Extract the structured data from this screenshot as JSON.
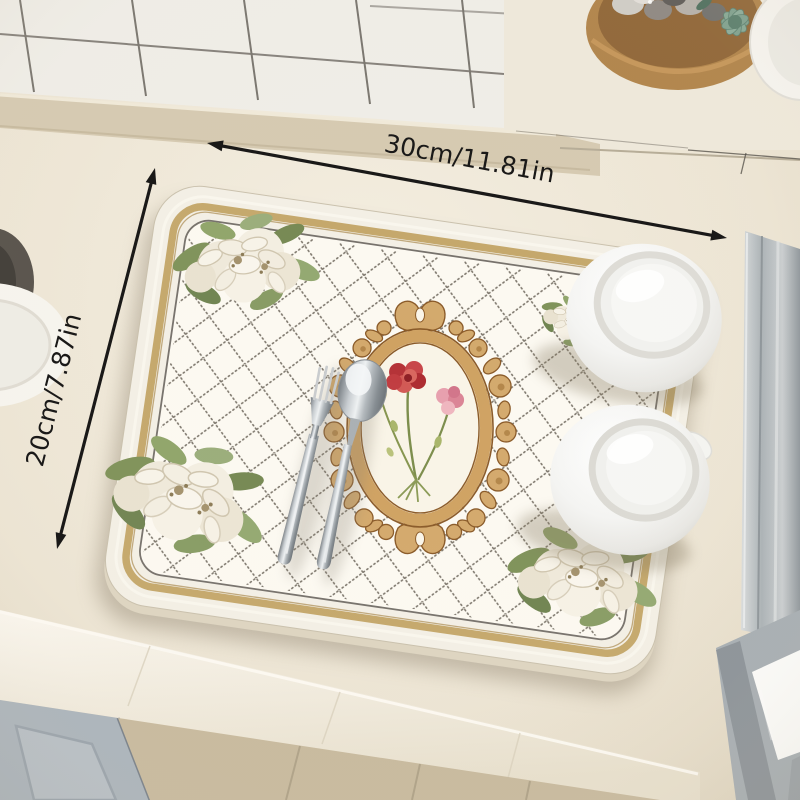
{
  "meta": {
    "type": "product-photo",
    "subject": "quilted dish-drying mat with baroque floral print on a kitchen countertop"
  },
  "annotations": {
    "width_label": "30cm/11.81in",
    "height_label": "20cm/7.87in",
    "arrow_color": "#1a1918"
  },
  "palette": {
    "mat_base": "#f3efe5",
    "mat_border_gold": "#c4a76a",
    "quilt_dot": "#6e675c",
    "ornament_gold": "#cfa262",
    "ornament_outline": "#8a5a28",
    "carnation_red": "#c0393c",
    "carnation_pink": "#e294a0",
    "leaf_green": "#7f9460",
    "countertop": "#ece4d3",
    "cabinet_grey": "#aab3bb",
    "floor_tile": "#c7b99d",
    "steel": "#aab0b5",
    "grout": "#4a453f"
  },
  "scene_objects": [
    "tiled wall",
    "window ledge",
    "wooden bowl with pebbles",
    "succulent plant",
    "white dish",
    "dark pot",
    "white plate",
    "stainless sink edge",
    "drying mat",
    "baroque frame ornament",
    "carnation bouquet",
    "white flower clusters",
    "fork",
    "spoon",
    "two upside-down white mugs",
    "countertop edge",
    "cabinet panel",
    "floor tiles",
    "metal frame"
  ]
}
